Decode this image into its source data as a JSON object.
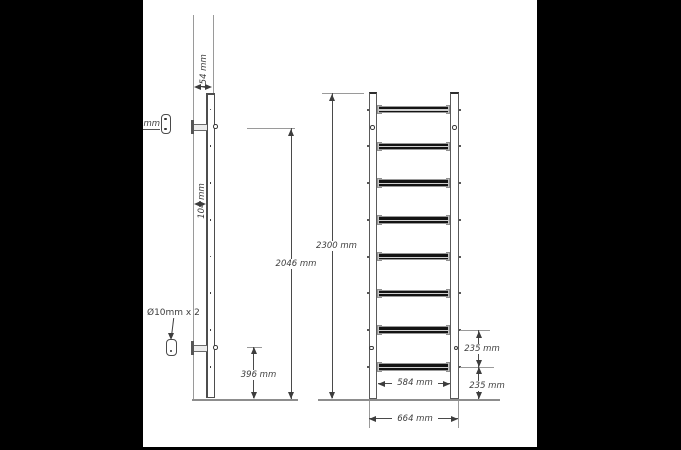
{
  "diagram_type": "wall-bars technical drawing, side and front elevation with dimensions",
  "side_view": {
    "depth_total_label": "154 mm",
    "wall_offset_label": "104 mm",
    "screw_label": "75 mm",
    "anchor_label": "Ø10mm x 2",
    "upper_bracket_height_label": "2046 mm",
    "lower_bracket_height_label": "396 mm"
  },
  "front_view": {
    "rung_count": 8,
    "total_height_label": "2300 mm",
    "rung_spacing_label": "235 mm",
    "bottom_rung_height_label": "235 mm",
    "inner_width_label": "584 mm",
    "outer_width_label": "664 mm"
  },
  "colors": {
    "background": "#ffffff",
    "redaction": "#000000",
    "construction_line": "#9a9a9a",
    "outline": "#4d4d4d",
    "rung_fill": "#141414",
    "text": "#3d3d3d"
  }
}
